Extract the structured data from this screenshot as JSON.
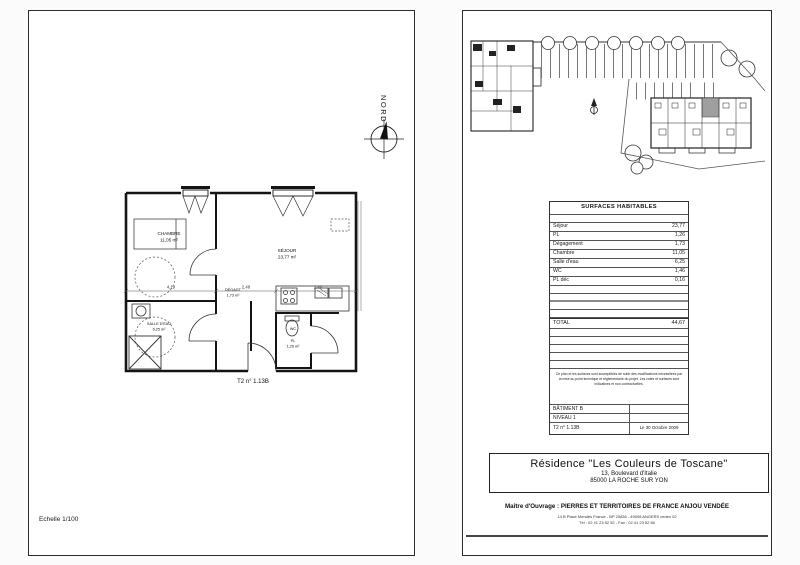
{
  "left_page": {
    "scale_label": "Echelle 1/100",
    "compass_label": "NORD",
    "plan_label": "T2 n° 1.13B",
    "rooms": {
      "chambre_name": "CHAMBRE",
      "chambre_area": "11,05 m²",
      "sejour_name": "SÉJOUR",
      "sejour_area": "23,77 m²",
      "degagt_name": "DÉGAGT",
      "degagt_area": "1,73 m²",
      "salle_deau_name": "SALLE D'EAU",
      "salle_deau_area": "6,25 m²",
      "wc_name": "WC",
      "pl_name": "PL",
      "pl_area": "1,26 m²"
    },
    "dimensions": [
      "4,19",
      "2,48",
      "2,40"
    ]
  },
  "right_page": {
    "table": {
      "title": "SURFACES HABITABLES",
      "rows": [
        {
          "label": "Séjour",
          "value": "23,77"
        },
        {
          "label": "PL",
          "value": "1,26"
        },
        {
          "label": "Dégagement",
          "value": "1,73"
        },
        {
          "label": "Chambre",
          "value": "11,05"
        },
        {
          "label": "Salle d'eau",
          "value": "6,25"
        },
        {
          "label": "WC",
          "value": "1,46"
        },
        {
          "label": "PL déc",
          "value": "0,16"
        }
      ],
      "total_label": "TOTAL",
      "total_value": "44,67"
    },
    "note": "Ce plan et les surfaces sont susceptibles de subir des modifications nécessitées par la mise au point technique et réglementaire du projet. Les cotes et surfaces sont indicatives et non contractuelles.",
    "info": {
      "batiment": "BÂTIMENT B",
      "niveau": "NIVEAU 1",
      "lot": "T2 n° 1.13B",
      "date": "Le 30 Octobre 2009"
    },
    "title_block": {
      "residence": "Résidence \"Les Couleurs de Toscane\"",
      "address1": "13, Boulevard d'Italie",
      "address2": "85000 LA ROCHE SUR YON"
    },
    "footer": {
      "maitre": "Maître d'Ouvrage : PIERRES ET TERRITOIRES DE FRANCE ANJOU VENDÉE",
      "address": "14 B Place Mendès France - BP 20836 - 49008 ANGERS cedex 02",
      "phone": "Tél : 02 41 23 52 52 - Fax : 02 41 23 52 66"
    }
  }
}
